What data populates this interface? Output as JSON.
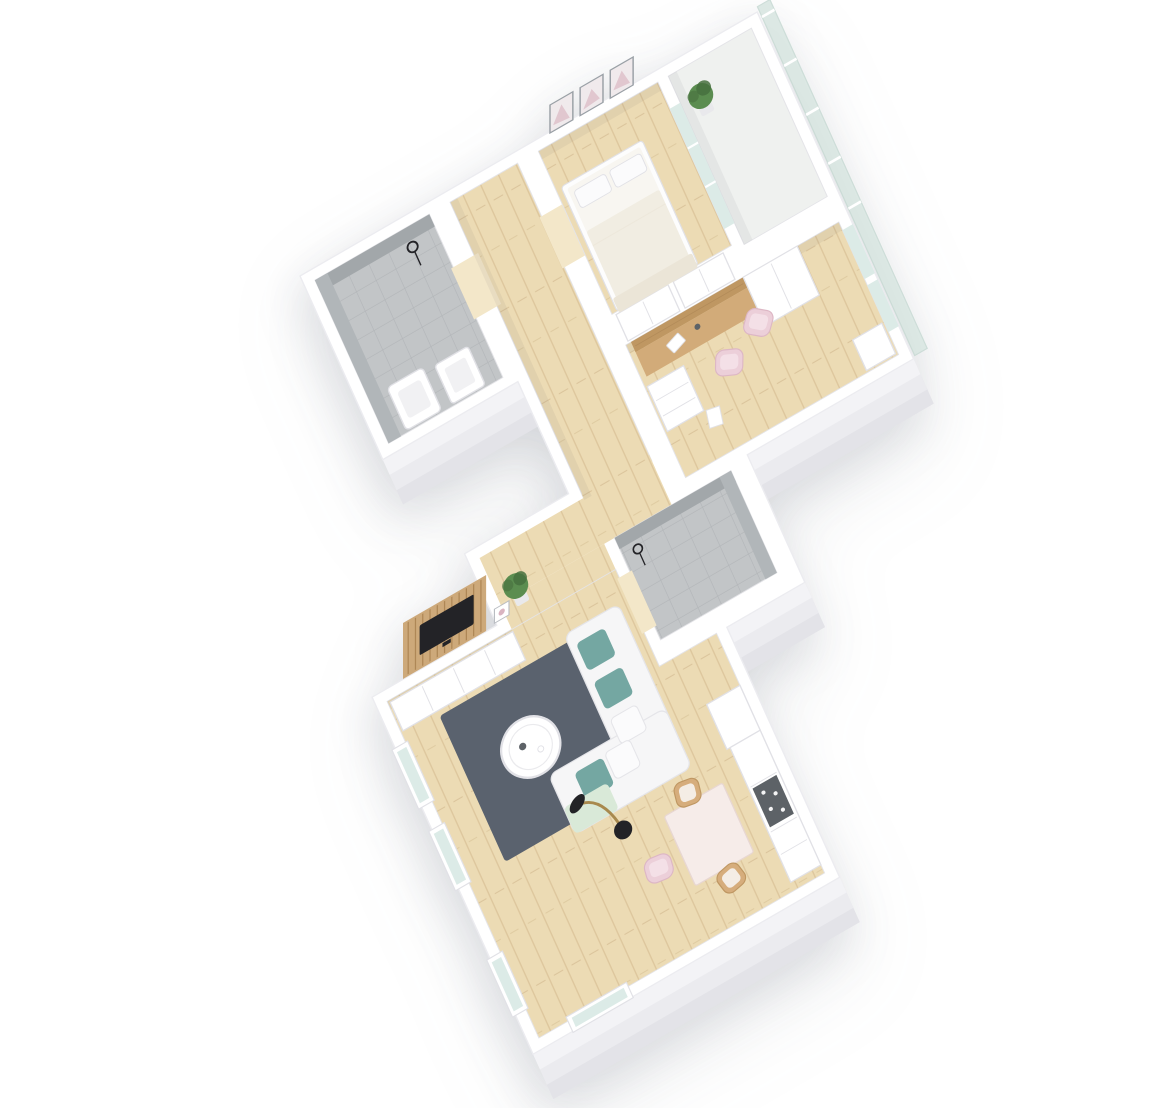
{
  "scene": {
    "kind": "isometric-3d-apartment-floor-plan",
    "background": "#ffffff",
    "rooms": [
      {
        "name": "bathroom",
        "floor": "gray-tile",
        "items": [
          "shower-head",
          "toilet",
          "washbasin"
        ]
      },
      {
        "name": "hallway",
        "floor": "light-wood",
        "items": [
          "wardrobe-cabinet",
          "wardrobe-cabinet"
        ]
      },
      {
        "name": "bedroom",
        "floor": "light-wood",
        "items": [
          "double-bed",
          "three-wall-pictures",
          "glass-door-to-balcony"
        ]
      },
      {
        "name": "balcony",
        "floor": "light-concrete",
        "items": [
          "potted-plant",
          "glass-railing"
        ]
      },
      {
        "name": "home-office",
        "floor": "light-wood",
        "items": [
          "wall-desk",
          "desk-cabinet",
          "dresser",
          "pink-chair",
          "pink-chair",
          "side-cabinet"
        ]
      },
      {
        "name": "shower-room",
        "floor": "gray-tile",
        "items": [
          "shower-head"
        ]
      },
      {
        "name": "living-room",
        "floor": "light-wood",
        "items": [
          "tv-slat-panel",
          "tv",
          "media-cabinet",
          "rug",
          "corner-sofa",
          "teal-cushions",
          "mint-blanket",
          "coffee-table",
          "arc-floor-lamp",
          "potted-plant"
        ]
      },
      {
        "name": "kitchen-dining",
        "floor": "light-wood",
        "items": [
          "tall-cabinet",
          "kitchen-counter",
          "cooktop",
          "dining-table",
          "wooden-chair",
          "wooden-chair"
        ]
      }
    ]
  },
  "palette": {
    "bg": "#ffffff",
    "wallTop": "#ffffff",
    "wallStroke": "#ececf0",
    "extrude1": "#f3f3f6",
    "extrude2": "#ebebef",
    "extrude3": "#e3e3e8",
    "floorStroke": "#e4e4e8",
    "innerShadow": "#2b2b3d",
    "wood": "#ecdbb4",
    "woodLine": "#ddc69c",
    "woodJoint": "#d2b98e",
    "woodLight": "#f3e7c9",
    "deskWood": "#d2ab79",
    "deskWoodDark": "#bf9762",
    "slat": "#cda97a",
    "slatLine": "#ae8756",
    "tileFloor": "#c2c5c7",
    "tileLine": "#b2b5b8",
    "tileWallDark": "#a2a7aa",
    "tileWallLight": "#b1b6b9",
    "balconyFloor": "#eff1ef",
    "glass": "#dcebe7",
    "railGlass": "#d9e6e2",
    "railStroke": "#c9dbd5",
    "rug": "#5a626e",
    "sofa": "#f6f6f7",
    "sofaStroke": "#e5e5e9",
    "teal": "#74a7a2",
    "mint": "#d9e9d8",
    "pillow": "#fbfbfc",
    "white": "#ffffff",
    "furnStroke": "#e1e1e6",
    "dark": "#232327",
    "gold": "#a8894e",
    "cooktop": "#5d6267",
    "dotWhite": "#f4f4f5",
    "pinkChair": "#eccfd9",
    "pinkChairStroke": "#ddb7c5",
    "pinkInner": "#f4e0e7",
    "tableTop": "#f6ece9",
    "tableStroke": "#e8d7d2",
    "woodChair": "#d6ad7c",
    "cushion": "#f4ede5",
    "plant": "#5b8d50",
    "plantDark": "#47703e",
    "pot": "#e9e9ec",
    "bedFrame": "#fdfdfd",
    "mattress": "#f8f6f1",
    "duvet": "#f1ede2",
    "drape": "#ebe5d7",
    "frameGray": "#9aa0a6",
    "artBg": "#f0eaec",
    "artPink": "#d9b4c0",
    "photoStroke": "#b9bdc2",
    "fixtureInner": "#f1f1f3"
  }
}
